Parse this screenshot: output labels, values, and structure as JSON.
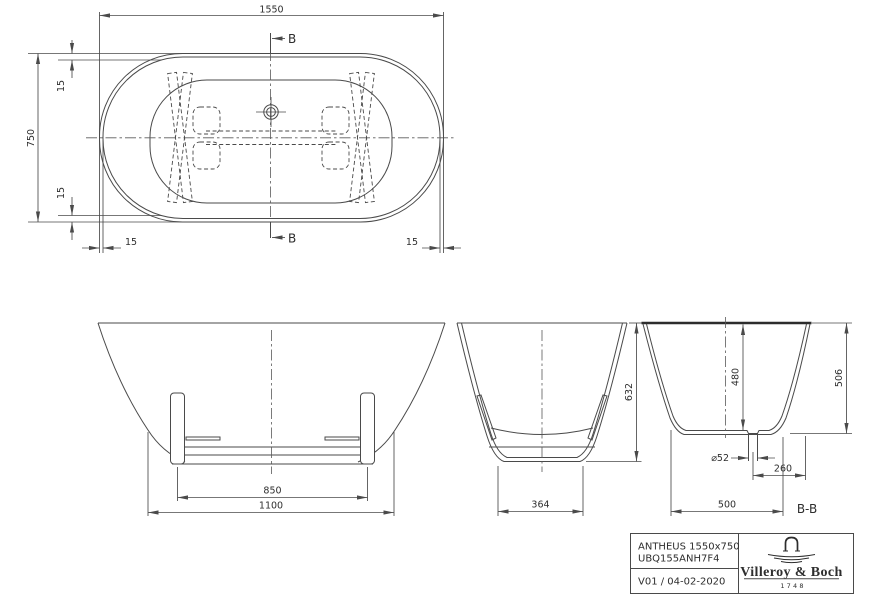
{
  "plan": {
    "length": "1550",
    "width": "750",
    "lip_top": "15",
    "lip_bottom": "15",
    "lip_left": "15",
    "lip_right": "15",
    "section_marker_top": "B",
    "section_marker_bottom": "B"
  },
  "front": {
    "support_span": "850",
    "base_width": "1100"
  },
  "side": {
    "height": "632",
    "base_width": "364"
  },
  "section_bb": {
    "inner_depth": "480",
    "outer_height": "506",
    "drain_diameter": "⌀52",
    "drain_offset": "260",
    "base_width": "500",
    "label": "B-B"
  },
  "title_block": {
    "product": "ANTHEUS 1550x750",
    "article_code": "UBQ155ANH7F4",
    "revision": "V01 / 04-02-2020",
    "brand": "Villeroy & Boch",
    "brand_year": "1748"
  },
  "colors": {
    "line": "#4a4a4a",
    "text": "#2e2e2e",
    "background": "#ffffff"
  }
}
